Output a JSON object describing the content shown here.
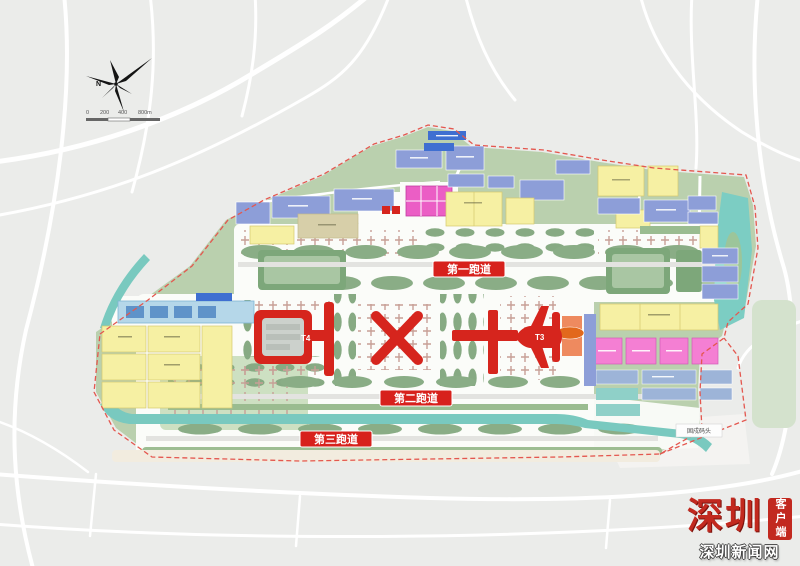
{
  "map": {
    "compass": {
      "north": "N",
      "scale_ticks": [
        "0",
        "200",
        "400",
        "800m"
      ]
    },
    "runways": [
      {
        "label": "第一跑道"
      },
      {
        "label": "第二跑道"
      },
      {
        "label": "第三跑道"
      }
    ],
    "terminals": {
      "t3": "T3",
      "t4": "T4"
    },
    "labels": {
      "dock": "固戍码头"
    },
    "legend_colors": {
      "terminal_red": "#d6251d",
      "runway_badge_red": "#d7211c",
      "apron_stand_green": "#87aa83",
      "land_green": "#bad0ae",
      "water_teal": "#79c9bf",
      "zone_yellow": "#f6f0a3",
      "zone_blue": "#8d9ed8",
      "zone_pink": "#f47fd3",
      "zone_magenta": "#eb5ec5",
      "zone_orange": "#ee8a5f"
    }
  },
  "watermark": {
    "logo_text": "深圳",
    "site_name": "深圳新闻网",
    "badge": "客户端"
  }
}
